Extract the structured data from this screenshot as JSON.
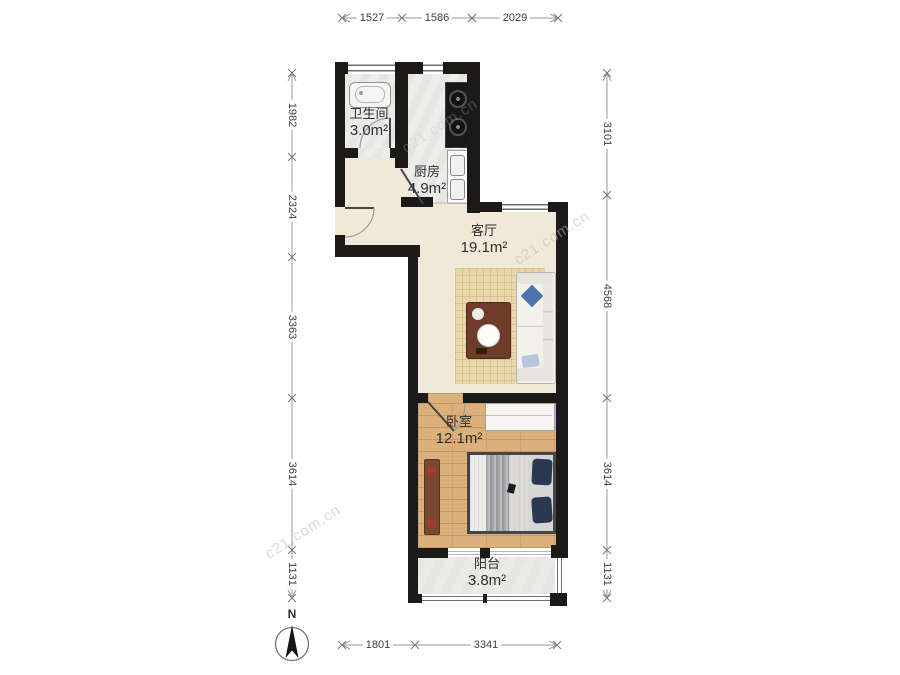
{
  "compass": {
    "label": "N"
  },
  "watermark": {
    "text": "c21.com.cn"
  },
  "rooms": [
    {
      "name": "卫生间",
      "area": "3.0m²"
    },
    {
      "name": "厨房",
      "area": "4.9m²"
    },
    {
      "name": "客厅",
      "area": "19.1m²"
    },
    {
      "name": "卧室",
      "area": "12.1m²"
    },
    {
      "name": "阳台",
      "area": "3.8m²"
    }
  ],
  "dimensions": {
    "top": [
      "1527",
      "1586",
      "2029"
    ],
    "left": [
      "1982",
      "2324",
      "3363",
      "3614",
      "1131"
    ],
    "right": [
      "3101",
      "4568",
      "3614",
      "1131"
    ],
    "bottom": [
      "1801",
      "3341"
    ]
  },
  "colors": {
    "wall": "#1c1a18",
    "living_floor": "#f0e9d7",
    "wood_floor": "#dcb07a",
    "tile_floor": "#ededeb",
    "rug": "#e8d8ab",
    "sofa_pillow_blue": "#4d74ad",
    "bed_pillow_navy": "#2a3850",
    "table_brown": "#6d3d2a"
  }
}
